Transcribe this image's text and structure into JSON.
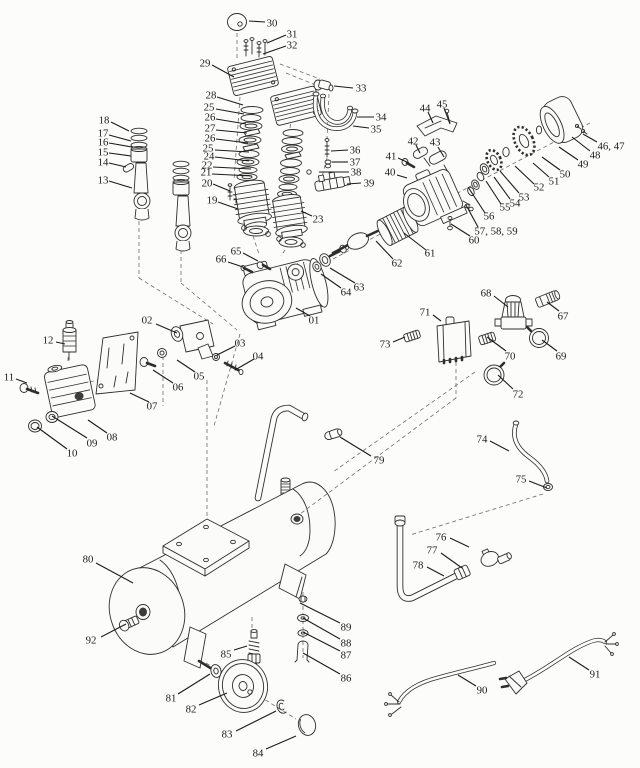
{
  "colors": {
    "background": "#fcfcfb",
    "ink": "#2e2e2c",
    "label": "#1b1b1b"
  },
  "labels": [
    {
      "t": "30",
      "x": 272,
      "y": 23,
      "l": [
        265,
        22,
        249,
        21
      ]
    },
    {
      "t": "31",
      "x": 292,
      "y": 34,
      "l": [
        286,
        35,
        267,
        43
      ]
    },
    {
      "t": "32",
      "x": 292,
      "y": 45,
      "l": [
        286,
        46,
        263,
        54
      ]
    },
    {
      "t": "29",
      "x": 205,
      "y": 63,
      "l": [
        212,
        65,
        234,
        77
      ]
    },
    {
      "t": "33",
      "x": 361,
      "y": 88,
      "l": [
        353,
        88,
        334,
        86
      ]
    },
    {
      "t": "34",
      "x": 381,
      "y": 117,
      "l": [
        374,
        117,
        357,
        117
      ]
    },
    {
      "t": "35",
      "x": 376,
      "y": 129,
      "l": [
        369,
        128,
        353,
        126
      ]
    },
    {
      "t": "28",
      "x": 211,
      "y": 95,
      "l": [
        217,
        97,
        243,
        105
      ]
    },
    {
      "t": "25",
      "x": 209,
      "y": 107,
      "l": [
        216,
        109,
        244,
        114
      ]
    },
    {
      "t": "26",
      "x": 210,
      "y": 117,
      "l": [
        216,
        119,
        246,
        124
      ]
    },
    {
      "t": "27",
      "x": 210,
      "y": 128,
      "l": [
        216,
        130,
        247,
        133
      ]
    },
    {
      "t": "26",
      "x": 210,
      "y": 138,
      "l": [
        216,
        139,
        248,
        143
      ]
    },
    {
      "t": "25",
      "x": 208,
      "y": 148,
      "l": [
        215,
        150,
        249,
        152
      ]
    },
    {
      "t": "24",
      "x": 209,
      "y": 156,
      "l": [
        215,
        157,
        249,
        161
      ]
    },
    {
      "t": "22",
      "x": 207,
      "y": 165,
      "l": [
        213,
        167,
        251,
        169
      ]
    },
    {
      "t": "21",
      "x": 206,
      "y": 172,
      "l": [
        212,
        174,
        252,
        176
      ]
    },
    {
      "t": "20",
      "x": 207,
      "y": 183,
      "l": [
        213,
        184,
        230,
        191
      ]
    },
    {
      "t": "19",
      "x": 212,
      "y": 200,
      "l": [
        218,
        202,
        238,
        209
      ]
    },
    {
      "t": "23",
      "x": 318,
      "y": 219,
      "l": [
        312,
        216,
        301,
        211
      ]
    },
    {
      "t": "18",
      "x": 104,
      "y": 120,
      "l": [
        111,
        122,
        129,
        131
      ]
    },
    {
      "t": "17",
      "x": 103,
      "y": 133,
      "l": [
        109,
        135,
        131,
        141
      ]
    },
    {
      "t": "16",
      "x": 103,
      "y": 142,
      "l": [
        109,
        143,
        132,
        147
      ]
    },
    {
      "t": "15",
      "x": 103,
      "y": 152,
      "l": [
        109,
        153,
        131,
        156
      ]
    },
    {
      "t": "14",
      "x": 103,
      "y": 162,
      "l": [
        109,
        163,
        126,
        167
      ]
    },
    {
      "t": "13",
      "x": 103,
      "y": 180,
      "l": [
        109,
        181,
        132,
        188
      ]
    },
    {
      "t": "36",
      "x": 355,
      "y": 150,
      "l": [
        348,
        150,
        331,
        151
      ]
    },
    {
      "t": "37",
      "x": 355,
      "y": 162,
      "l": [
        348,
        162,
        332,
        162
      ]
    },
    {
      "t": "38",
      "x": 356,
      "y": 172,
      "l": [
        349,
        172,
        319,
        172
      ]
    },
    {
      "t": "39",
      "x": 369,
      "y": 183,
      "l": [
        361,
        183,
        347,
        184
      ]
    },
    {
      "t": "44",
      "x": 425,
      "y": 108,
      "l": [
        428,
        112,
        433,
        123
      ]
    },
    {
      "t": "45",
      "x": 442,
      "y": 104,
      "l": [
        444,
        108,
        450,
        124
      ]
    },
    {
      "t": "42",
      "x": 413,
      "y": 141,
      "l": [
        416,
        145,
        420,
        153
      ]
    },
    {
      "t": "43",
      "x": 435,
      "y": 142,
      "l": [
        438,
        147,
        444,
        157
      ]
    },
    {
      "t": "41",
      "x": 391,
      "y": 156,
      "l": [
        398,
        158,
        409,
        163
      ]
    },
    {
      "t": "40",
      "x": 390,
      "y": 172,
      "l": [
        397,
        175,
        407,
        178
      ]
    },
    {
      "t": "46, 47",
      "x": 611,
      "y": 146,
      "l": [
        597,
        142,
        583,
        134
      ]
    },
    {
      "t": "48",
      "x": 595,
      "y": 155,
      "l": [
        590,
        151,
        572,
        137
      ]
    },
    {
      "t": "49",
      "x": 583,
      "y": 164,
      "l": [
        578,
        160,
        559,
        147
      ]
    },
    {
      "t": "50",
      "x": 565,
      "y": 174,
      "l": [
        560,
        170,
        542,
        157
      ]
    },
    {
      "t": "51",
      "x": 554,
      "y": 181,
      "l": [
        549,
        177,
        533,
        163
      ]
    },
    {
      "t": "52",
      "x": 539,
      "y": 187,
      "l": [
        534,
        184,
        515,
        166
      ]
    },
    {
      "t": "53",
      "x": 524,
      "y": 197,
      "l": [
        519,
        193,
        500,
        171
      ]
    },
    {
      "t": "54",
      "x": 515,
      "y": 203,
      "l": [
        510,
        199,
        494,
        177
      ]
    },
    {
      "t": "55",
      "x": 505,
      "y": 207,
      "l": [
        501,
        204,
        486,
        181
      ]
    },
    {
      "t": "56",
      "x": 489,
      "y": 216,
      "l": [
        485,
        213,
        468,
        187
      ]
    },
    {
      "t": "57, 58, 59",
      "x": 496,
      "y": 231,
      "l": [
        478,
        227,
        466,
        205
      ]
    },
    {
      "t": "60",
      "x": 474,
      "y": 240,
      "l": [
        470,
        236,
        451,
        224
      ]
    },
    {
      "t": "61",
      "x": 430,
      "y": 253,
      "l": [
        426,
        250,
        404,
        233
      ]
    },
    {
      "t": "62",
      "x": 397,
      "y": 263,
      "l": [
        393,
        259,
        376,
        241
      ]
    },
    {
      "t": "63",
      "x": 359,
      "y": 287,
      "l": [
        355,
        283,
        330,
        268
      ]
    },
    {
      "t": "64",
      "x": 346,
      "y": 292,
      "l": [
        341,
        288,
        321,
        274
      ]
    },
    {
      "t": "65",
      "x": 236,
      "y": 251,
      "l": [
        243,
        253,
        258,
        261
      ]
    },
    {
      "t": "66",
      "x": 221,
      "y": 259,
      "l": [
        228,
        262,
        243,
        267
      ]
    },
    {
      "t": "01",
      "x": 314,
      "y": 320,
      "l": [
        310,
        316,
        296,
        308
      ]
    },
    {
      "t": "02",
      "x": 147,
      "y": 320,
      "l": [
        156,
        324,
        177,
        333
      ]
    },
    {
      "t": "03",
      "x": 240,
      "y": 343,
      "l": [
        235,
        346,
        217,
        355
      ]
    },
    {
      "t": "04",
      "x": 258,
      "y": 356,
      "l": [
        254,
        359,
        235,
        370
      ]
    },
    {
      "t": "05",
      "x": 199,
      "y": 376,
      "l": [
        195,
        372,
        177,
        360
      ]
    },
    {
      "t": "06",
      "x": 178,
      "y": 387,
      "l": [
        173,
        383,
        153,
        370
      ]
    },
    {
      "t": "07",
      "x": 152,
      "y": 406,
      "l": [
        149,
        402,
        130,
        393
      ]
    },
    {
      "t": "08",
      "x": 112,
      "y": 437,
      "l": [
        107,
        433,
        88,
        420
      ]
    },
    {
      "t": "09",
      "x": 92,
      "y": 443,
      "l": [
        87,
        438,
        52,
        416
      ]
    },
    {
      "t": "10",
      "x": 72,
      "y": 453,
      "l": [
        67,
        449,
        37,
        427
      ]
    },
    {
      "t": "11",
      "x": 9,
      "y": 377,
      "l": [
        16,
        379,
        27,
        383
      ]
    },
    {
      "t": "12",
      "x": 48,
      "y": 340,
      "l": [
        56,
        342,
        65,
        344
      ]
    },
    {
      "t": "68",
      "x": 486,
      "y": 293,
      "l": [
        494,
        296,
        508,
        307
      ]
    },
    {
      "t": "67",
      "x": 563,
      "y": 316,
      "l": [
        559,
        311,
        547,
        302
      ]
    },
    {
      "t": "71",
      "x": 425,
      "y": 312,
      "l": [
        433,
        315,
        441,
        321
      ]
    },
    {
      "t": "73",
      "x": 385,
      "y": 344,
      "l": [
        393,
        342,
        405,
        337
      ]
    },
    {
      "t": "70",
      "x": 510,
      "y": 356,
      "l": [
        506,
        351,
        487,
        337
      ]
    },
    {
      "t": "69",
      "x": 561,
      "y": 356,
      "l": [
        557,
        351,
        542,
        340
      ]
    },
    {
      "t": "72",
      "x": 518,
      "y": 394,
      "l": [
        513,
        389,
        498,
        375
      ]
    },
    {
      "t": "74",
      "x": 482,
      "y": 439,
      "l": [
        490,
        441,
        509,
        451
      ]
    },
    {
      "t": "75",
      "x": 521,
      "y": 479,
      "l": [
        529,
        481,
        547,
        488
      ]
    },
    {
      "t": "76",
      "x": 441,
      "y": 537,
      "l": [
        450,
        538,
        469,
        547
      ]
    },
    {
      "t": "77",
      "x": 432,
      "y": 550,
      "l": [
        441,
        553,
        462,
        568
      ]
    },
    {
      "t": "78",
      "x": 418,
      "y": 565,
      "l": [
        427,
        567,
        444,
        576
      ]
    },
    {
      "t": "79",
      "x": 379,
      "y": 460,
      "l": [
        371,
        456,
        340,
        437
      ]
    },
    {
      "t": "80",
      "x": 88,
      "y": 559,
      "l": [
        96,
        563,
        133,
        583
      ]
    },
    {
      "t": "92",
      "x": 91,
      "y": 640,
      "l": [
        101,
        637,
        126,
        624
      ]
    },
    {
      "t": "85",
      "x": 226,
      "y": 654,
      "l": [
        234,
        650,
        247,
        646
      ]
    },
    {
      "t": "81",
      "x": 171,
      "y": 698,
      "l": [
        178,
        694,
        210,
        674
      ]
    },
    {
      "t": "82",
      "x": 191,
      "y": 709,
      "l": [
        199,
        705,
        227,
        693
      ]
    },
    {
      "t": "83",
      "x": 227,
      "y": 734,
      "l": [
        236,
        731,
        276,
        711
      ]
    },
    {
      "t": "84",
      "x": 258,
      "y": 753,
      "l": [
        266,
        749,
        296,
        736
      ]
    },
    {
      "t": "89",
      "x": 346,
      "y": 627,
      "l": [
        340,
        623,
        300,
        603
      ]
    },
    {
      "t": "88",
      "x": 346,
      "y": 643,
      "l": [
        340,
        639,
        303,
        618
      ]
    },
    {
      "t": "87",
      "x": 346,
      "y": 655,
      "l": [
        340,
        651,
        303,
        632
      ]
    },
    {
      "t": "86",
      "x": 346,
      "y": 678,
      "l": [
        340,
        674,
        303,
        653
      ]
    },
    {
      "t": "90",
      "x": 482,
      "y": 690,
      "l": [
        476,
        686,
        458,
        675
      ]
    },
    {
      "t": "91",
      "x": 595,
      "y": 674,
      "l": [
        589,
        670,
        569,
        657
      ]
    }
  ]
}
